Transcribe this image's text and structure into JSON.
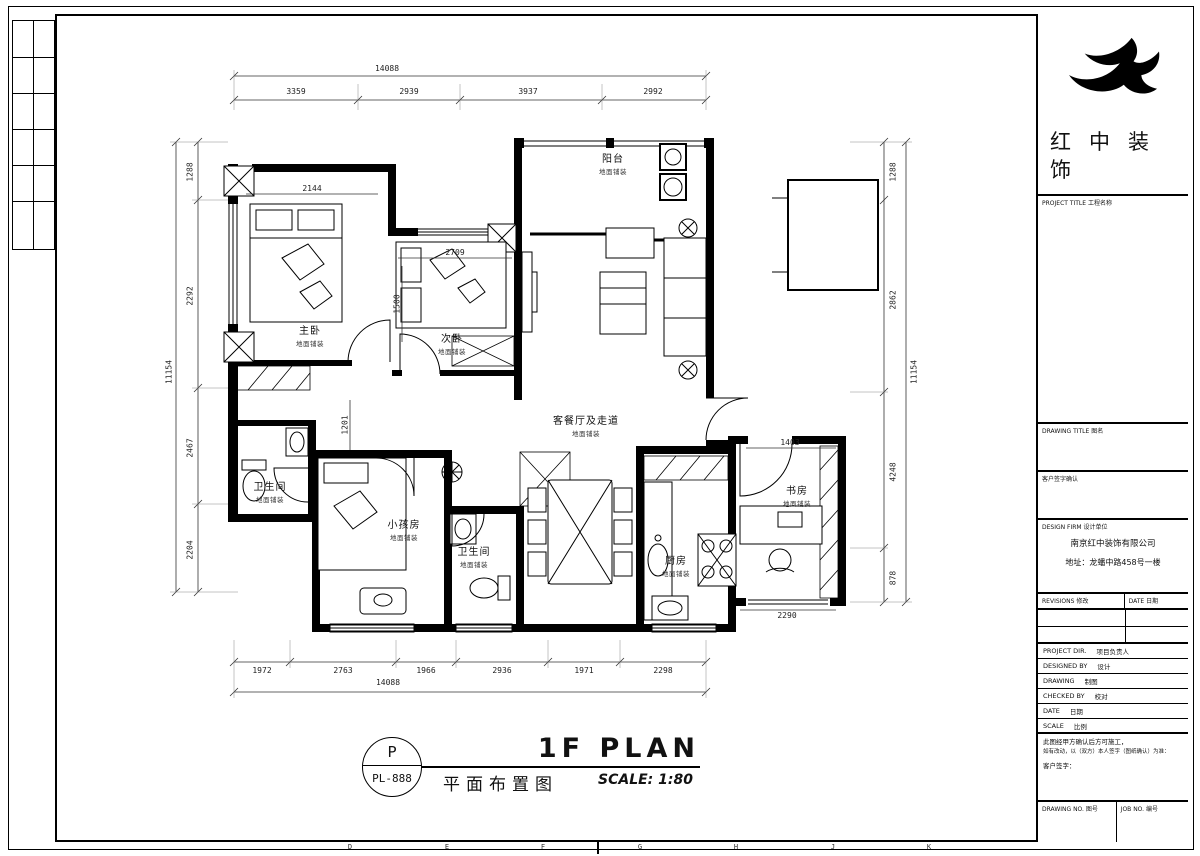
{
  "logo": {
    "line1": "红中装",
    "line2": "饰"
  },
  "title_block": {
    "project_title": "PROJECT TITLE  工程名称",
    "drawing_title": "DRAWING TITLE  图名",
    "client_confirm": "客户签字确认",
    "design_firm": "DESIGN FIRM  设计单位",
    "company_name": "南京红中装饰有限公司",
    "company_address": "地址：龙蟠中路458号一楼",
    "revisions": "REVISIONS  修改",
    "revision_date": "DATE  日期",
    "rows": [
      {
        "en": "PROJECT DIR.",
        "cn": "项目负责人"
      },
      {
        "en": "DESIGNED BY",
        "cn": "设计"
      },
      {
        "en": "DRAWING",
        "cn": "制图"
      },
      {
        "en": "CHECKED BY",
        "cn": "校对"
      },
      {
        "en": "DATE",
        "cn": "日期"
      },
      {
        "en": "SCALE",
        "cn": "比例"
      }
    ],
    "note_line1": "此图经甲方确认后方可施工，",
    "note_line2": "如有改动，以（双方）本人签字（图纸确认）为准：",
    "client_sign": "客户签字：",
    "drawing_no": "DRAWING NO.  图号",
    "job_no": "JOB NO.  编号"
  },
  "plan_title": {
    "symbol": "P",
    "number": "PL-888",
    "title": "1F PLAN",
    "title_cn": "平面布置图",
    "scale": "SCALE: 1:80"
  },
  "rooms": [
    {
      "name": "阳台",
      "sub": "地面铺装"
    },
    {
      "name": "主卧",
      "sub": "地面铺装"
    },
    {
      "name": "次卧",
      "sub": "地面铺装"
    },
    {
      "name": "客餐厅及走道",
      "sub": "地面铺装"
    },
    {
      "name": "卫生间",
      "sub": "地面铺装"
    },
    {
      "name": "小孩房",
      "sub": "地面铺装"
    },
    {
      "name": "卫生间",
      "sub": "地面铺装"
    },
    {
      "name": "厨房",
      "sub": "地面铺装"
    },
    {
      "name": "书房",
      "sub": "地面铺装"
    }
  ],
  "dimensions": {
    "top": {
      "overall": "14088",
      "segments": [
        "3359",
        "2939",
        "3937",
        "2992"
      ]
    },
    "bottom": {
      "overall": "14088",
      "segments": [
        "1972",
        "2763",
        "1966",
        "2936",
        "1971",
        "2298"
      ]
    },
    "left": {
      "overall": "11154",
      "segments": [
        "1288",
        "2292",
        "2467",
        "2204"
      ]
    },
    "right": {
      "overall": "11154",
      "segments": [
        "1288",
        "2862",
        "4248",
        "878"
      ]
    },
    "interior": [
      "2144",
      "2709",
      "1500",
      "1201",
      "1403",
      "2290"
    ]
  },
  "frame": {
    "bottom_letters": [
      "D",
      "E",
      "F",
      "G",
      "H",
      "J",
      "K"
    ]
  }
}
